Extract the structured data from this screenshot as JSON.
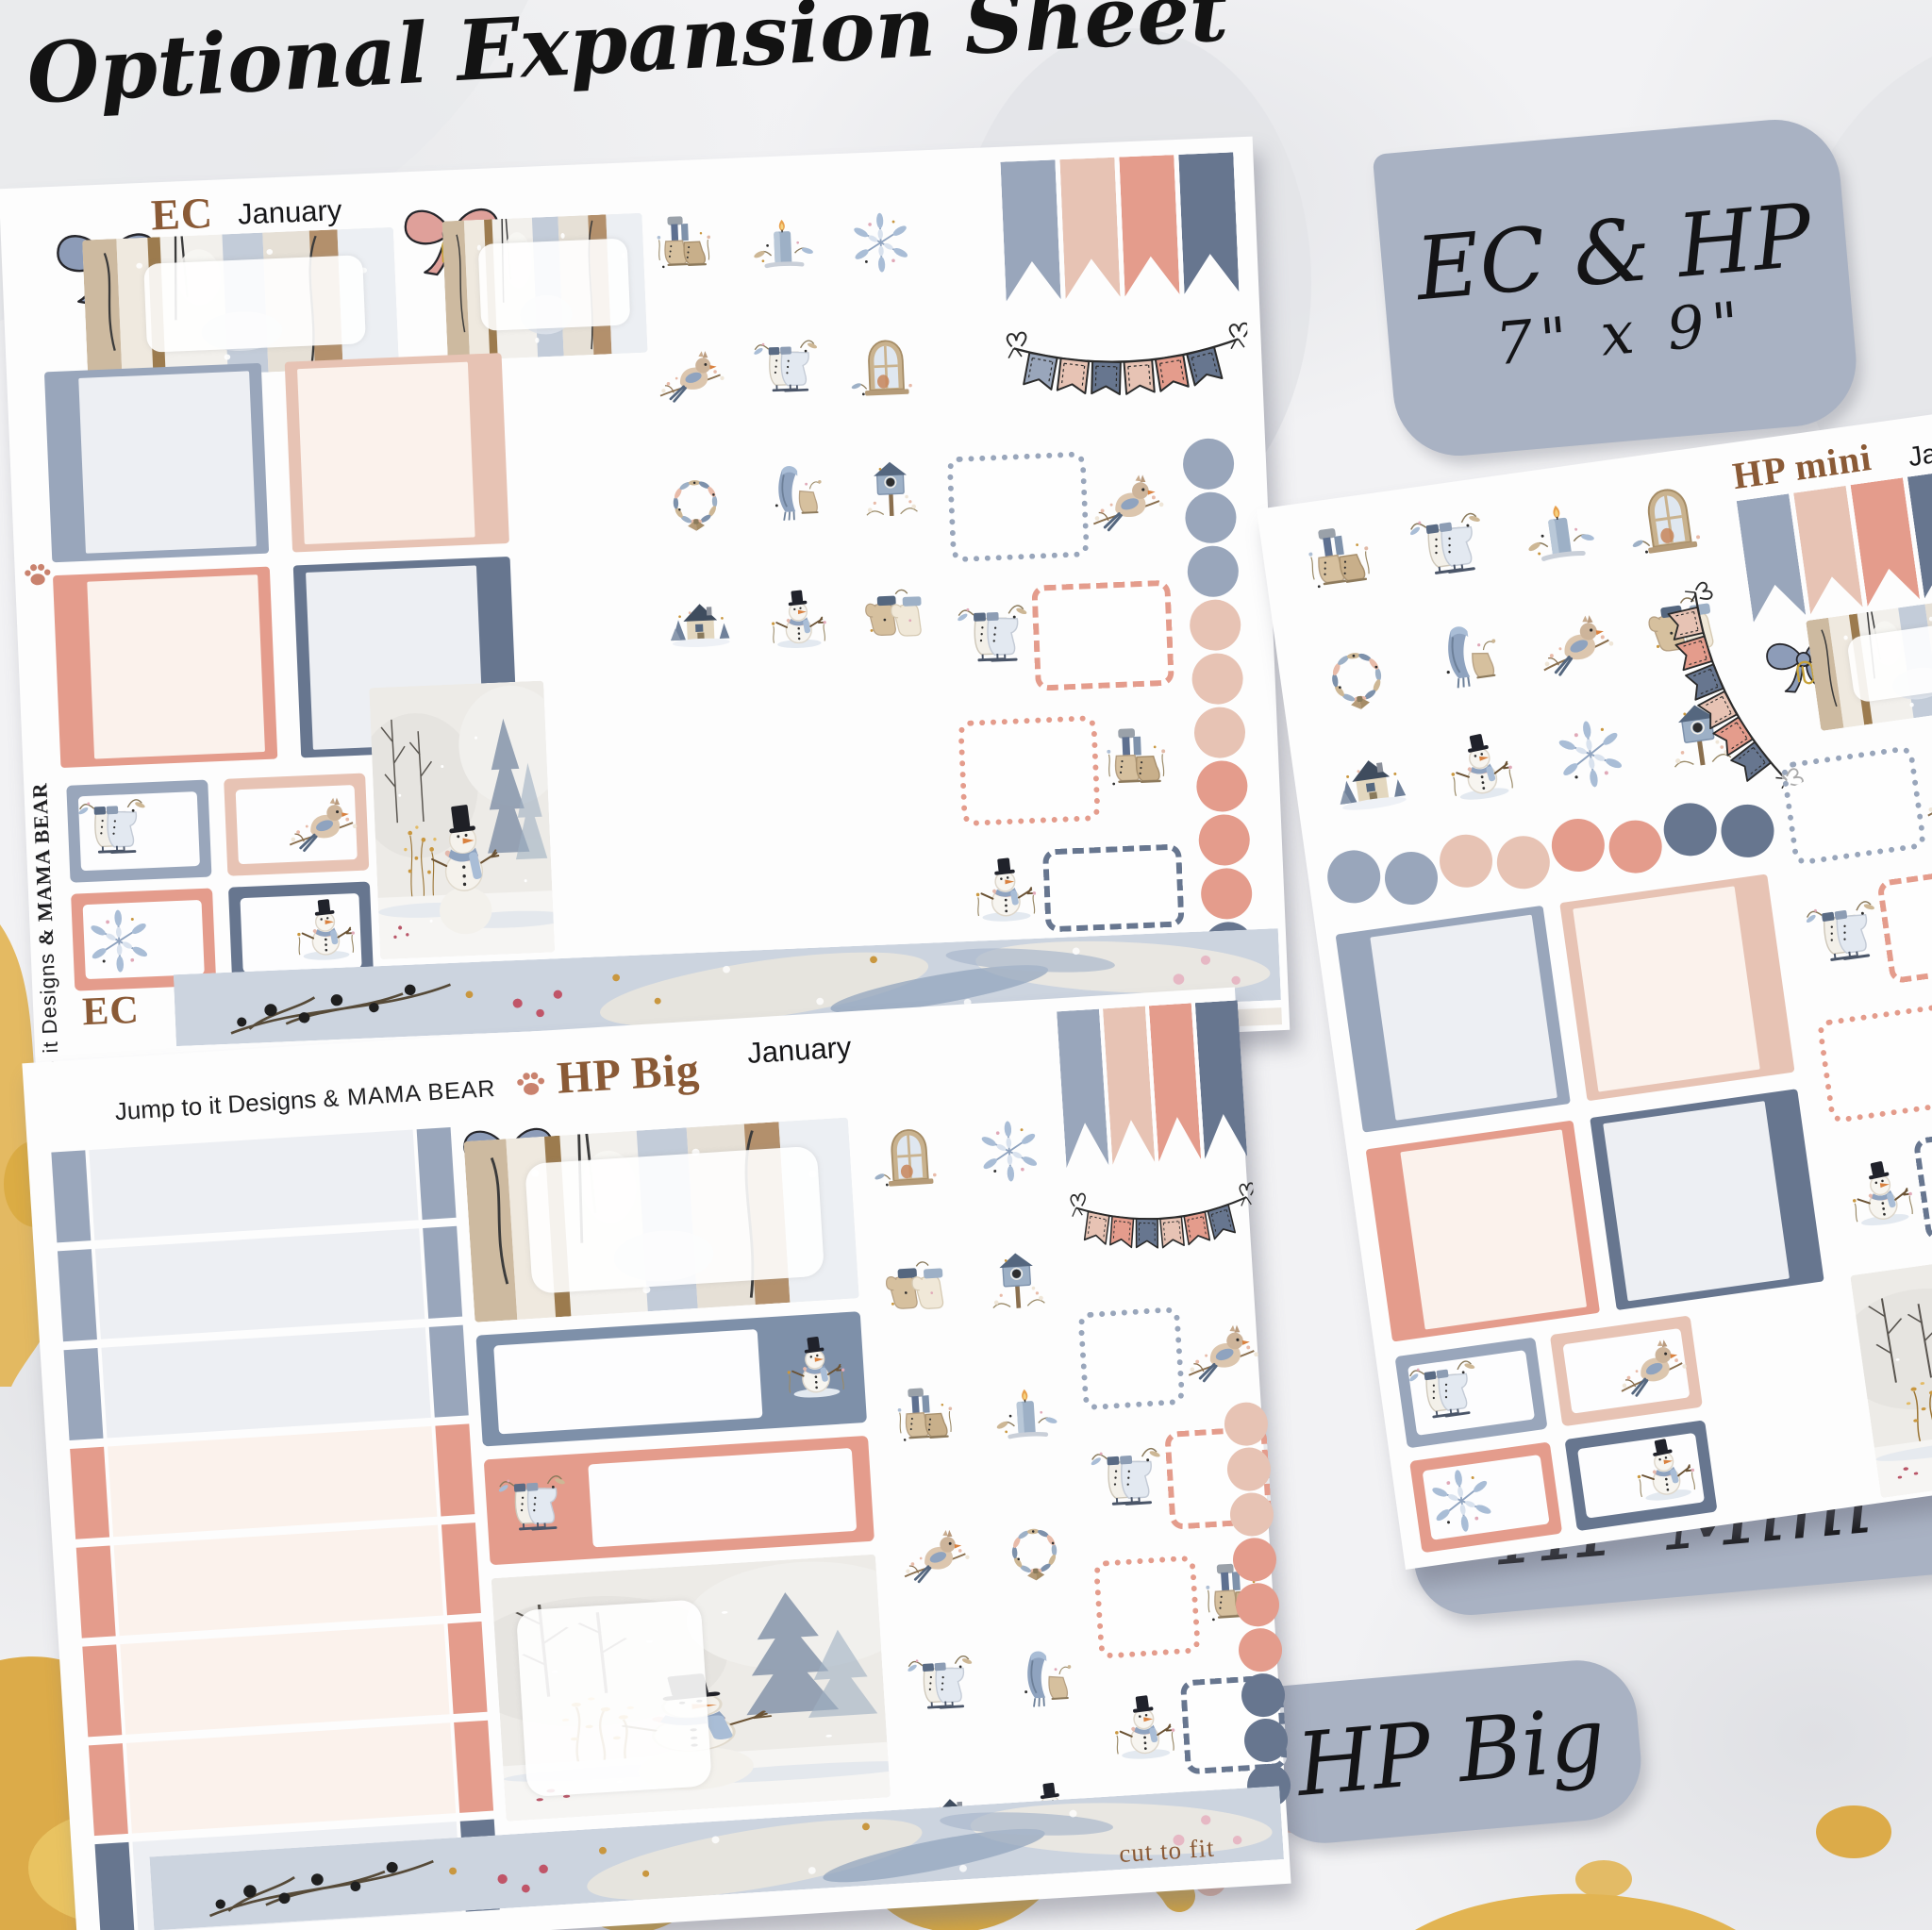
{
  "title": "Optional Expansion Sheet",
  "palette": {
    "gray": "#99a6bb",
    "blush": "#e7c3b4",
    "salmon": "#e49c8c",
    "dark": "#67768f",
    "cream": "#fbf2ec",
    "light": "#edeff3",
    "brown": "#8a5a36",
    "tab_gray": "#a9b2c3",
    "washi": "#ccd4df",
    "gold": "#dcab49",
    "ink": "#1d1d1f"
  },
  "size_label": {
    "line1": "EC & HP",
    "line2": "7\" x 9\""
  },
  "tabs": {
    "hp_mini": "HP Mini",
    "hp_big": "HP Big"
  },
  "sheets": {
    "ec": {
      "code": "EC",
      "month": "January",
      "footer_code": "EC",
      "brand": {
        "script": "Jump to it Designs ",
        "caps": "& MAMA BEAR"
      },
      "icon_grid": [
        "boots",
        "candle",
        "snowflake",
        "cardinal",
        "skates",
        "window",
        "wreath",
        "scarf",
        "birdhouse",
        "house",
        "snowman",
        "mittens"
      ],
      "pennants": [
        "gray",
        "blush",
        "salmon",
        "dark"
      ],
      "bunting": [
        "gray",
        "blush",
        "dark",
        "blush",
        "salmon",
        "dark"
      ],
      "dot_column": [
        "gray",
        "gray",
        "gray",
        "blush",
        "blush",
        "blush",
        "salmon",
        "salmon",
        "salmon",
        "dark"
      ],
      "full_boxes": [
        {
          "edge": "gray",
          "fill": "light",
          "thick": "left"
        },
        {
          "edge": "blush",
          "fill": "cream",
          "thick": "right"
        },
        {
          "edge": "salmon",
          "fill": "cream",
          "thick": "left"
        },
        {
          "edge": "dark",
          "fill": "light",
          "thick": "right"
        }
      ],
      "half_boxes": [
        {
          "color": "gray",
          "icon": "skates",
          "side": "left"
        },
        {
          "color": "blush",
          "icon": "cardinal",
          "side": "right"
        },
        {
          "color": "salmon",
          "icon": "snowflake",
          "side": "left"
        },
        {
          "color": "dark",
          "icon": "snowman",
          "side": "right"
        }
      ],
      "dotted_boxes": [
        {
          "style": "dotted",
          "color": "gray",
          "icon": "cardinal",
          "side": "right"
        },
        {
          "style": "dashed",
          "color": "salmon",
          "icon": "skates",
          "side": "left"
        },
        {
          "style": "dotted",
          "color": "salmon",
          "icon": "boots",
          "side": "right"
        },
        {
          "style": "dashed",
          "color": "dark",
          "icon": "snowman",
          "side": "left"
        }
      ]
    },
    "hp_mini": {
      "code": "HP mini",
      "month": "Jan",
      "side_text": "Jump to it Designs",
      "icon_grid": [
        "boots",
        "skates",
        "candle",
        "window",
        "wreath",
        "scarf",
        "cardinal",
        "gloves",
        "house",
        "snowman",
        "snowflake",
        "birdhouse"
      ],
      "pennants": [
        "gray",
        "blush",
        "salmon",
        "dark"
      ],
      "bunting": [
        "blush",
        "salmon",
        "dark",
        "blush",
        "salmon",
        "dark"
      ],
      "dots_row": [
        "gray",
        "gray",
        "blush",
        "blush",
        "salmon",
        "salmon",
        "dark",
        "dark"
      ],
      "full_boxes": [
        {
          "edge": "gray",
          "fill": "light",
          "thick": "left"
        },
        {
          "edge": "blush",
          "fill": "cream",
          "thick": "right"
        },
        {
          "edge": "salmon",
          "fill": "cream",
          "thick": "left"
        },
        {
          "edge": "dark",
          "fill": "light",
          "thick": "right"
        }
      ],
      "half_boxes": [
        {
          "color": "gray",
          "icon": "skates",
          "side": "left"
        },
        {
          "color": "blush",
          "icon": "cardinal",
          "side": "right"
        },
        {
          "color": "salmon",
          "icon": "snowflake",
          "side": "left"
        },
        {
          "color": "dark",
          "icon": "snowman",
          "side": "right"
        }
      ],
      "dotted_boxes": [
        {
          "style": "dotted",
          "color": "gray",
          "icon": "cardinal",
          "side": "right"
        },
        {
          "style": "dashed",
          "color": "salmon",
          "icon": "skates",
          "side": "left"
        },
        {
          "style": "dotted",
          "color": "salmon",
          "icon": "boots",
          "side": "right"
        },
        {
          "style": "dashed",
          "color": "dark",
          "icon": "snowman",
          "side": "left"
        }
      ]
    },
    "hp_big": {
      "code": "HP Big",
      "month": "January",
      "cut_note": "cut to fit",
      "brand": {
        "script": "Jump to it Designs ",
        "caps": "& MAMA BEAR"
      },
      "icon_grid": [
        "window",
        "snowflake",
        "mittens",
        "birdhouse",
        "boots",
        "candle",
        "cardinal",
        "wreath",
        "skates",
        "scarf",
        "house",
        "snowman"
      ],
      "strips": [
        "gray",
        "gray",
        "gray",
        "salmon",
        "salmon",
        "salmon",
        "salmon",
        "dark"
      ],
      "pennants": [
        "gray",
        "blush",
        "salmon",
        "dark"
      ],
      "bunting": [
        "blush",
        "salmon",
        "dark",
        "blush",
        "salmon",
        "dark"
      ],
      "dot_column": [
        "blush",
        "blush",
        "blush",
        "salmon",
        "salmon",
        "salmon",
        "dark",
        "dark",
        "dark"
      ],
      "dotted_boxes": [
        {
          "style": "dotted",
          "color": "gray",
          "icon": "cardinal",
          "side": "right"
        },
        {
          "style": "dashed",
          "color": "salmon",
          "icon": "skates",
          "side": "left"
        },
        {
          "style": "dotted",
          "color": "salmon",
          "icon": "boots",
          "side": "right"
        },
        {
          "style": "dashed",
          "color": "dark",
          "icon": "snowman",
          "side": "left"
        }
      ]
    }
  }
}
